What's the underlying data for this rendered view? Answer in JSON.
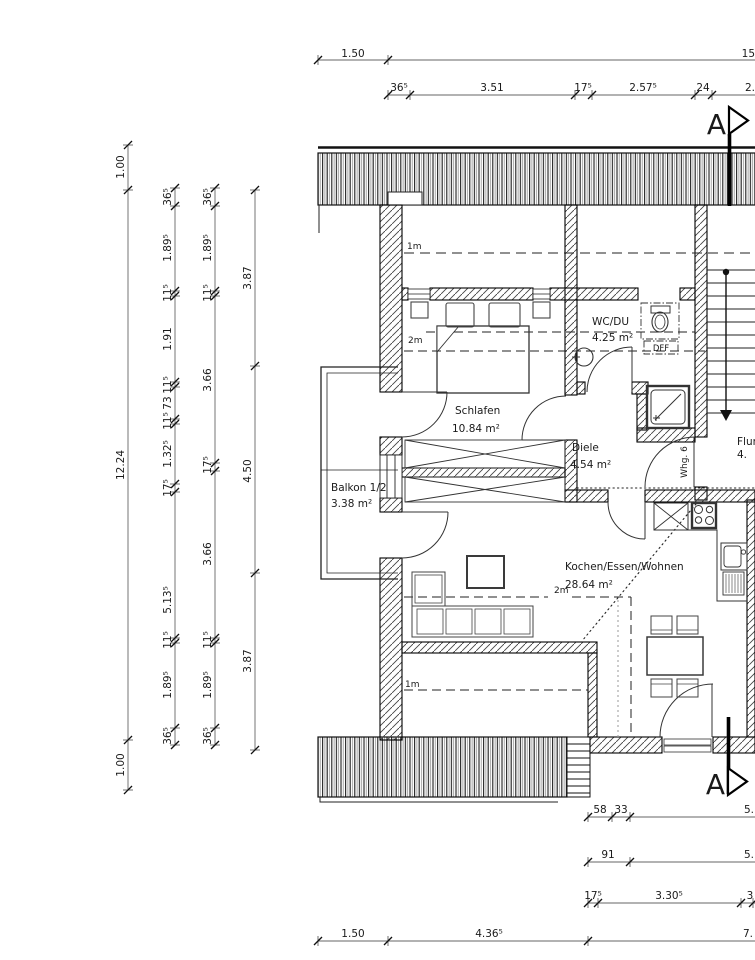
{
  "rooms": {
    "schlafen": {
      "name": "Schlafen",
      "area": "10.84  m²"
    },
    "balkon": {
      "name": "Balkon  1/2",
      "area": "3.38  m²"
    },
    "wc": {
      "name": "WC/DU",
      "area": "4.25  m²"
    },
    "diele": {
      "name": "Diele",
      "area": "4.54  m²"
    },
    "wohnen": {
      "name": "Kochen/Essen/Wohnen",
      "area": "28.64  m²"
    },
    "flur": {
      "name": "Flur",
      "area": "4."
    }
  },
  "labels": {
    "dff": "DFF",
    "whg": "Whg. 6",
    "h2m": "2m",
    "h1m": "1m",
    "section": "A"
  },
  "dims": {
    "top1": [
      "1.50",
      "15."
    ],
    "top2": [
      "36⁵",
      "3.51",
      "17⁵",
      "2.57⁵",
      "24",
      "2."
    ],
    "left1": [
      "1.00",
      "12.24",
      "1.00"
    ],
    "left2": [
      "36⁵",
      "1.89⁵",
      "11⁵",
      "1.91",
      "11⁵",
      "73",
      "11⁵",
      "1.32⁵",
      "17⁵",
      "5.13⁵",
      "11⁵",
      "1.89⁵",
      "36⁵"
    ],
    "left3": [
      "36⁵",
      "1.89⁵",
      "11⁵",
      "3.66",
      "17⁵",
      "3.66",
      "11⁵",
      "1.89⁵",
      "36⁵"
    ],
    "left4": [
      "3.87",
      "4.50",
      "3.87"
    ],
    "bottom1": [
      "58",
      "33",
      "5."
    ],
    "bottom2": [
      "91",
      "5."
    ],
    "bottom3": [
      "17⁵",
      "3.30⁵",
      "3"
    ],
    "bottom4": [
      "1.50",
      "4.36⁵",
      "7."
    ]
  },
  "colors": {
    "line": "#1a1a1a",
    "hatch": "#444444",
    "dimline": "#666666"
  }
}
